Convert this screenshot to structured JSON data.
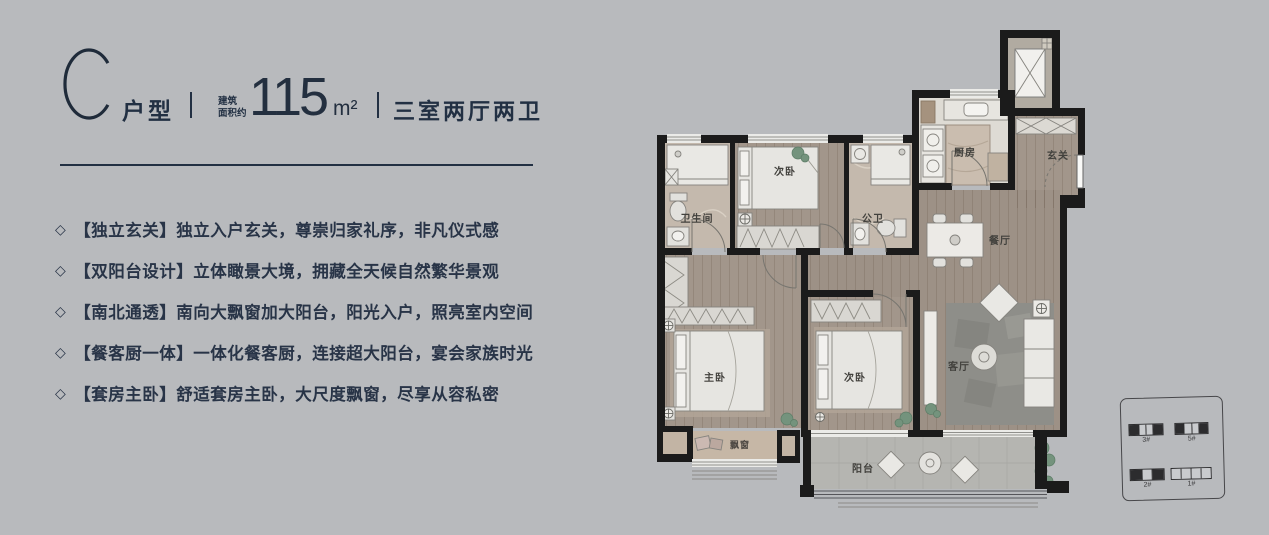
{
  "palette": {
    "background": "#b8babd",
    "accent_navy": "#223043",
    "wall": "#1b1b1b",
    "wood_floor": "#a2968b",
    "tile_floor": "#c4b9ad",
    "balcony_floor": "#b5b5b1"
  },
  "header": {
    "type_letter": "C",
    "type_label": "户型",
    "area_caption_line1": "建筑",
    "area_caption_line2": "面积约",
    "area_value": "115",
    "area_unit": "m²",
    "spec": "三室两厅两卫"
  },
  "features": {
    "bullet": "◇",
    "items": [
      "【独立玄关】独立入户玄关，尊崇归家礼序，非凡仪式感",
      "【双阳台设计】立体瞰景大境，拥藏全天候自然繁华景观",
      "【南北通透】南向大飘窗加大阳台，阳光入户，照亮室内空间",
      "【餐客厨一体】一体化餐客厨，连接超大阳台，宴会家族时光",
      "【套房主卧】舒适套房主卧，大尺度飘窗，尽享从容私密"
    ]
  },
  "floor_plan": {
    "rooms": {
      "ensuite_bath": "卫生间",
      "bedroom_top": "次卧",
      "public_bath": "公卫",
      "kitchen": "厨房",
      "entry": "玄关",
      "dining": "餐厅",
      "master_bedroom": "主卧",
      "bedroom_bottom": "次卧",
      "living": "客厅",
      "bay_window": "飘窗",
      "balcony": "阳台"
    }
  },
  "site_map": {
    "buildings": [
      {
        "label": "3#",
        "cells": [
          "dark",
          "light",
          "light",
          "dark"
        ]
      },
      {
        "label": "5#",
        "cells": [
          "dark",
          "light",
          "light",
          "dark"
        ]
      },
      {
        "label": "2#",
        "cells": [
          "dark",
          "light",
          "dark"
        ]
      },
      {
        "label": "1#",
        "cells": [
          "light",
          "light",
          "light",
          "light"
        ]
      }
    ]
  }
}
